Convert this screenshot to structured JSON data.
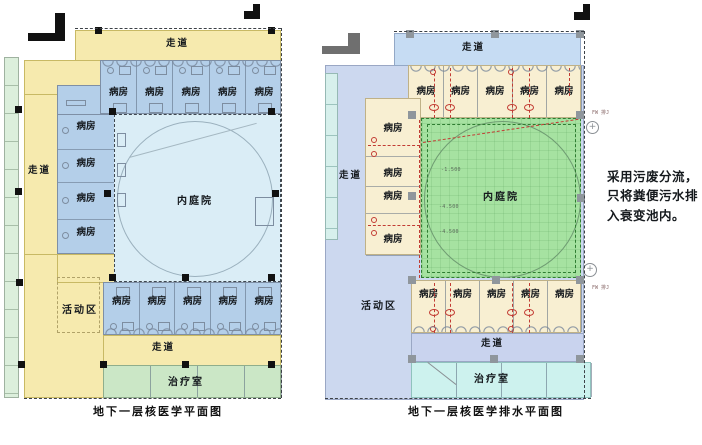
{
  "annotation": {
    "lines": [
      "采用污废分流，",
      "只将粪便污水排",
      "入衰变池内。"
    ]
  },
  "left_plan": {
    "caption": "地下一层核医学平面图",
    "labels": {
      "corridor_top": "走道",
      "corridor_left": "走道",
      "corridor_bottom": "走道",
      "courtyard": "内庭院",
      "activity": "活动区",
      "treatment": "治疗室"
    },
    "top_wards": [
      "病房",
      "病房",
      "病房",
      "病房",
      "病房"
    ],
    "left_wards": [
      "病房",
      "病房",
      "病房",
      "病房"
    ],
    "bottom_wards": [
      "病房",
      "病房",
      "病房",
      "病房",
      "病房"
    ]
  },
  "right_plan": {
    "caption": "地下一层核医学排水平面图",
    "labels": {
      "corridor_top": "走道",
      "corridor_left": "走道",
      "corridor_bottom": "走道",
      "courtyard": "内庭院",
      "activity": "活动区",
      "treatment": "治疗室"
    },
    "top_wards": [
      "病房",
      "病房",
      "病房",
      "病房",
      "病房"
    ],
    "left_wards": [
      "病房",
      "病房",
      "病房",
      "病房"
    ],
    "bottom_wards": [
      "病房",
      "病房",
      "病房",
      "病房",
      "病房"
    ],
    "elevations": [
      "-1.500",
      "-4.500",
      "-4.500"
    ],
    "riser_labels": [
      "FW 排J",
      "FW 排J"
    ]
  },
  "colors": {
    "left_corridor": "#f6eaae",
    "left_ward": "#b4cfe9",
    "left_courtyard": "#daedf6",
    "left_treatment": "#cbe7c6",
    "left_side_rooms": "#dcefdc",
    "right_base": "#ccd8ef",
    "right_corridor_top": "#c6dcf3",
    "right_ward": "#f8efd2",
    "right_courtyard": "#a6e2a1",
    "right_treatment": "#cdf2ee",
    "right_side_rooms": "#d7f0ec",
    "drain_pipe_red": "#c23b33"
  }
}
